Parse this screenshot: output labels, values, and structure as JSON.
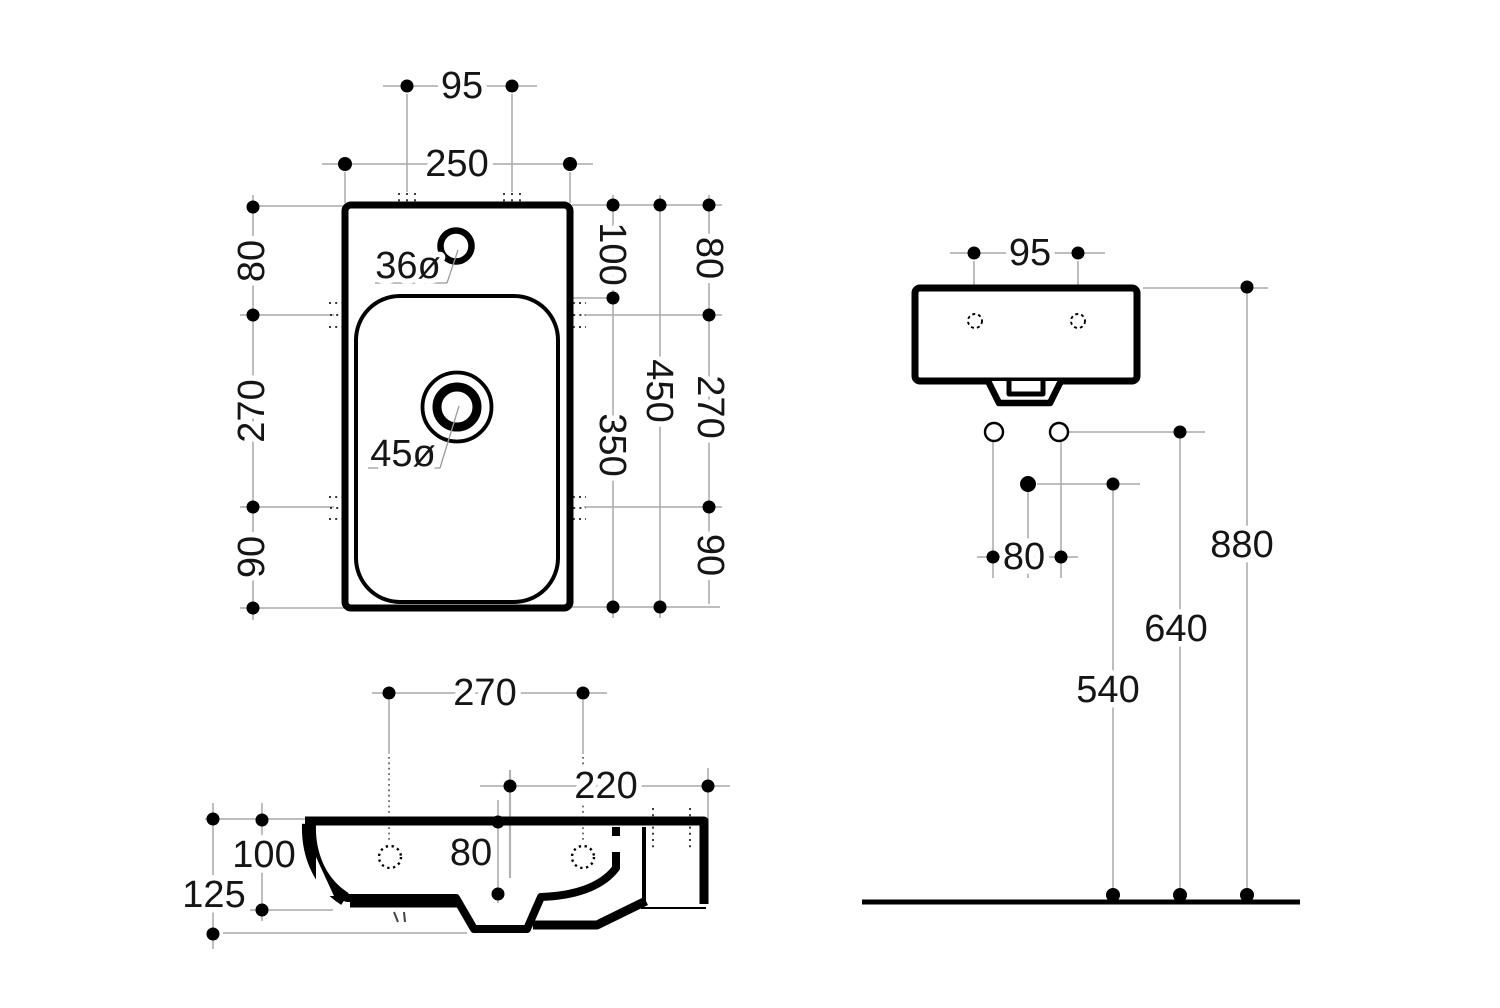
{
  "plan_view": {
    "hole_spacing": "95",
    "outer_width": "250",
    "left": {
      "top_offset": "80",
      "bracket_span": "270",
      "bottom_offset": "90"
    },
    "right_inner": {
      "rim_to_bowl": "100",
      "bowl_length": "350",
      "overall_length": "450"
    },
    "right_outer": {
      "top_offset": "80",
      "bracket_span": "270",
      "bottom_offset": "90"
    },
    "faucet_hole_dia": "36ø",
    "drain_hole_dia": "45ø"
  },
  "side_view": {
    "hole_depth_spacing": "270",
    "trap_offset": "220",
    "bowl_depth": "80",
    "front_height": "100",
    "overall_height": "125"
  },
  "front_view": {
    "hole_spacing": "95",
    "supply_spacing": "80",
    "drain_height": "540",
    "supply_height": "640",
    "rim_height": "880"
  }
}
